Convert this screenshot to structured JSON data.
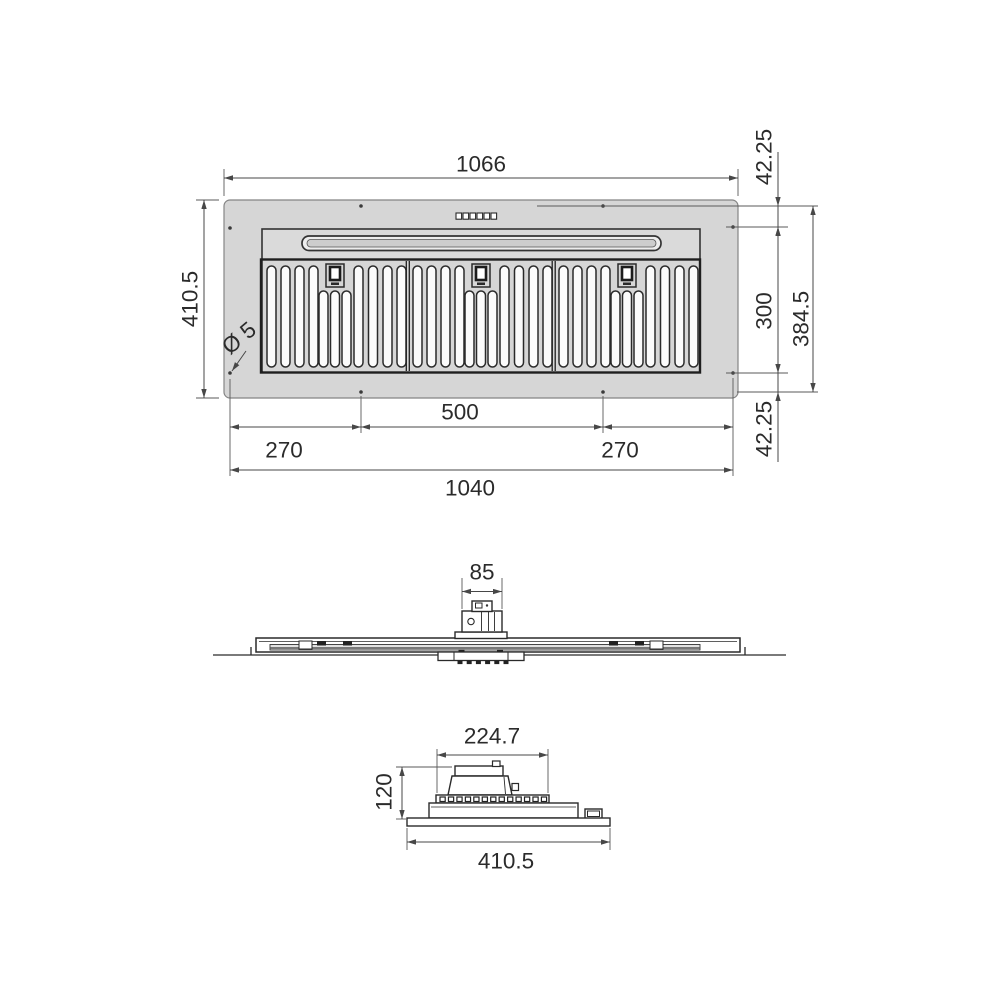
{
  "dimensions": {
    "top_view": {
      "overall_width": "1066",
      "overall_depth": "410.5",
      "hole_diameter": "Ø 5",
      "offset_top": "42.25",
      "body_depth": "300",
      "hole_pattern_depth": "384.5",
      "offset_bottom": "42.25",
      "hole_offset_left": "270",
      "hole_spacing_center": "500",
      "hole_offset_right": "270",
      "hole_pattern_width": "1040"
    },
    "front_view": {
      "duct_width": "85"
    },
    "side_view": {
      "motor_housing_length": "224.7",
      "body_height": "120",
      "body_depth": "410.5"
    }
  },
  "colors": {
    "panel_fill": "#d6d6d6",
    "body_fill": "#dadada",
    "outline": "#2a2a2a",
    "dimension_line": "#474747",
    "text": "#2b2b2b",
    "background": "#ffffff"
  }
}
